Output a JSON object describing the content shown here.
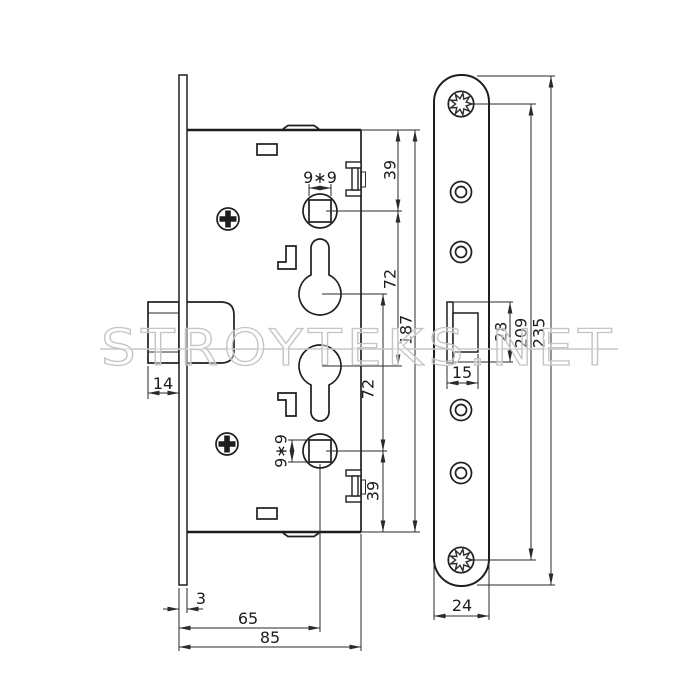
{
  "watermark": {
    "text": "STROYTEKS.NET"
  },
  "colors": {
    "line": "#1e1e1e",
    "watermark": "#c5c5c5",
    "background": "#ffffff"
  },
  "side_view": {
    "title": "mortise-lock-side-view",
    "dims": {
      "spindle_square_top": "9∗9",
      "spindle_square_bottom": "9∗9",
      "edge_to_spindle_top": "39",
      "spindle_to_cylinder_upper": "72",
      "cylinder_to_spindle_lower": "72",
      "spindle_to_edge_bottom": "39",
      "case_height": "187",
      "bolt_throw": "14",
      "faceplate_thickness": "3",
      "backset": "65",
      "case_depth": "85"
    }
  },
  "front_view": {
    "title": "faceplate-front-view",
    "dims": {
      "bolt_width": "15",
      "bolt_height": "28",
      "fixing_hole_spacing": "209",
      "faceplate_length": "235",
      "faceplate_width": "24"
    }
  }
}
